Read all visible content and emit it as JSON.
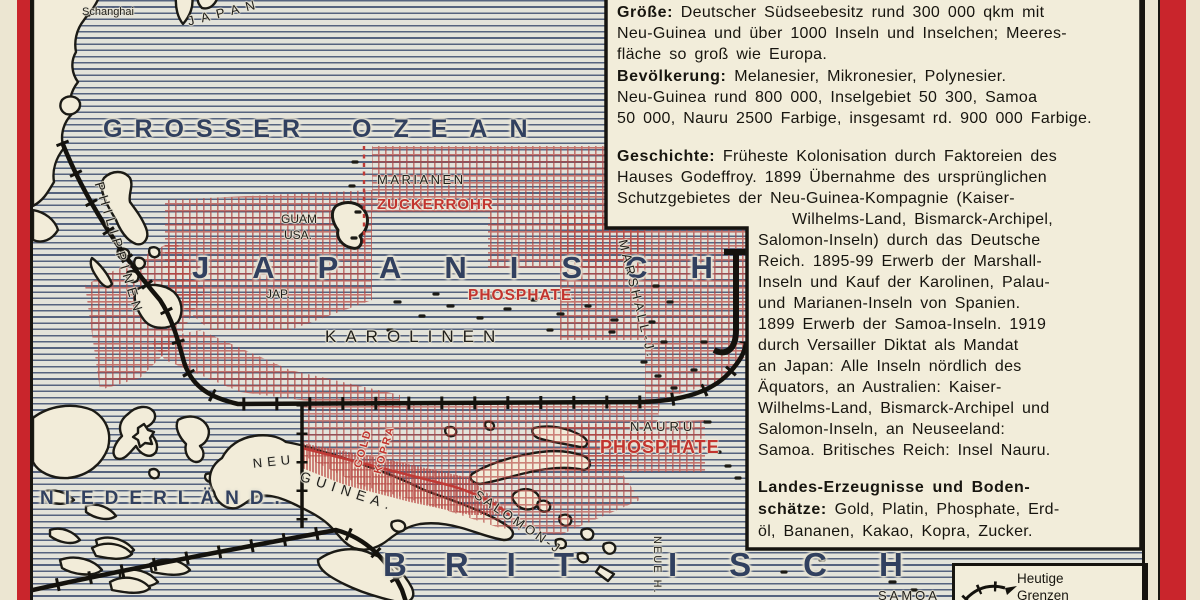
{
  "meta": {
    "title_context": "Vintage German school atlas plate: Deutscher Südseebesitz (German South Seas possessions), Pacific Ocean",
    "colors": {
      "paper_cream": "#ece6d2",
      "panel_cream": "#f2edda",
      "ocean_line_blue": "#55637f",
      "sea_label_navy": "#31405f",
      "accent_red": "#c2342f",
      "hatch_red": "#b5443f",
      "frame_red": "#c9252c",
      "line_black": "#16140f"
    }
  },
  "map": {
    "sea_labels": {
      "grosser": "GROSSER",
      "ozean": "OZEAN",
      "japanisch": "JAPANISCH",
      "brit": "BRIT",
      "isch": "ISCH",
      "niederlaend": "NIEDERLÄND."
    },
    "labels": {
      "schanghai": "Schanghai",
      "japan_top": "JAPAN",
      "philippinen": "PHILIPPINEN",
      "marianen": "MARIANEN",
      "zuckerrohr": "ZUCKERROHR",
      "guam": "GUAM",
      "usa": "USA.",
      "jap_small": "JAP.",
      "phosphate_north": "PHOSPHATE",
      "karolinen": "KAROLINEN",
      "marshall": "MARSHALL-J.",
      "nauru": "NAURU",
      "phosphate_south": "PHOSPHATE",
      "neu": "NEU",
      "guinea": "GUINEA.",
      "gold": "GOLD",
      "kopra": "KOPRA",
      "salomon": "SALOMON-J.",
      "neue_hebriden": "NEUE H.",
      "samoa": "SAMOA"
    }
  },
  "panel": {
    "groesse": {
      "label": "Größe:",
      "first": " Deutscher Südseebesitz rund 300 000 qkm mit",
      "lines": [
        "Neu-Guinea und über 1000 Inseln und Inselchen; Meeres-",
        "fläche so groß wie Europa."
      ]
    },
    "bevoelkerung": {
      "label": "Bevölkerung:",
      "first": " Melanesier, Mikronesier, Polynesier.",
      "lines": [
        "Neu-Guinea rund 800 000, Inselgebiet 50 300, Samoa",
        "50 000, Nauru 2500 Farbige, insgesamt rd. 900 000 Farbige."
      ]
    },
    "geschichte": {
      "label": "Geschichte:",
      "first": " Früheste Kolonisation durch Faktoreien des",
      "lines": [
        "Hauses Godeffroy. 1899 Übernahme des ursprünglichen",
        "Schutzgebietes der Neu-Guinea-Kompagnie (Kaiser-"
      ],
      "indent": [
        "Wilhelms-Land, Bismarck-Archipel,",
        "Salomon-Inseln) durch das Deutsche",
        "Reich. 1895-99 Erwerb der Marshall-",
        "Inseln und Kauf der Karolinen, Palau-",
        "und Marianen-Inseln von Spanien.",
        "1899 Erwerb der Samoa-Inseln. 1919",
        "durch Versailler Diktat als Mandat",
        "an Japan: Alle Inseln nördlich des",
        "Äquators, an Australien: Kaiser-",
        "Wilhelms-Land, Bismarck-Archipel und",
        "Salomon-Inseln, an Neuseeland:",
        "Samoa. Britisches Reich: Insel Nauru."
      ]
    },
    "landes": {
      "label": "Landes-Erzeugnisse und Boden-",
      "label2": "schätze:",
      "line2_rest": " Gold, Platin, Phosphate, Erd-",
      "line3": "öl, Bananen, Kakao, Kopra, Zucker."
    }
  },
  "legend": {
    "line1": "Heutige",
    "line2": "Grenzen"
  }
}
